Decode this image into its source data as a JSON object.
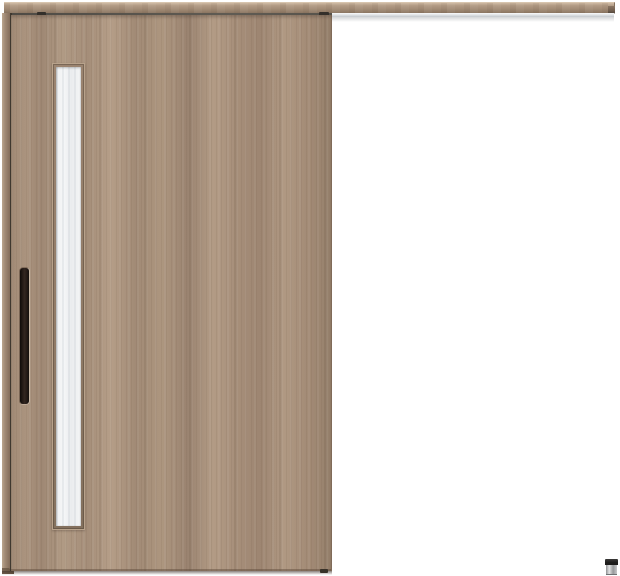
{
  "scene": {
    "type": "product-photo",
    "subject": "wood-grain outset sliding door hung from a top rail, fully open position at left, with vertical glass slit, black bar handle, exposed hanger rail extending right, and a small floor guide at bottom right",
    "background": "#ffffff",
    "text_content": "none — the image contains no rendered text"
  },
  "parts": {
    "top_rail": "wood-fascia hanger rail spanning full width",
    "rail_end_cap": "dark end bracket at right tip of rail",
    "hanger_track": "exposed aluminum track under fascia right of door",
    "door_hangers": "two dark roller brackets in gap above door",
    "door_panel": "flush wood-grain sliding door panel",
    "door_edge_stile": "visible door edge strip at far left",
    "glass_window": "tall narrow frosted glass slit near door's left edge",
    "door_handle": "vertical black bar pull handle",
    "floor_guide": "small metal floor guide with black cap at bottom right"
  },
  "colors": {
    "background": "#ffffff",
    "wood-base": "#ab947f",
    "wood-dark": "#8a7360",
    "wood-deep": "#7c6654",
    "fascia-top": "#cdb8a1",
    "fascia-bottom": "#8a7561",
    "track-groove": "#56524b",
    "track-metal": "#dcdfe2",
    "track-highlight": "#fafbfc",
    "hanger-dark": "#332f2a",
    "frame-wood": "#937d69",
    "frame-highlight": "#b8a28b",
    "glass-light": "#f6f7f8",
    "glass-mid": "#eaecee",
    "handle-black": "#15100d",
    "handle-sheen": "#332620",
    "shadow-brown": "rgba(61,48,39,0.6)",
    "guide-cap": "#1d1c1b",
    "guide-metal-light": "#e2e3e4",
    "guide-metal-dark": "#8f9193"
  }
}
